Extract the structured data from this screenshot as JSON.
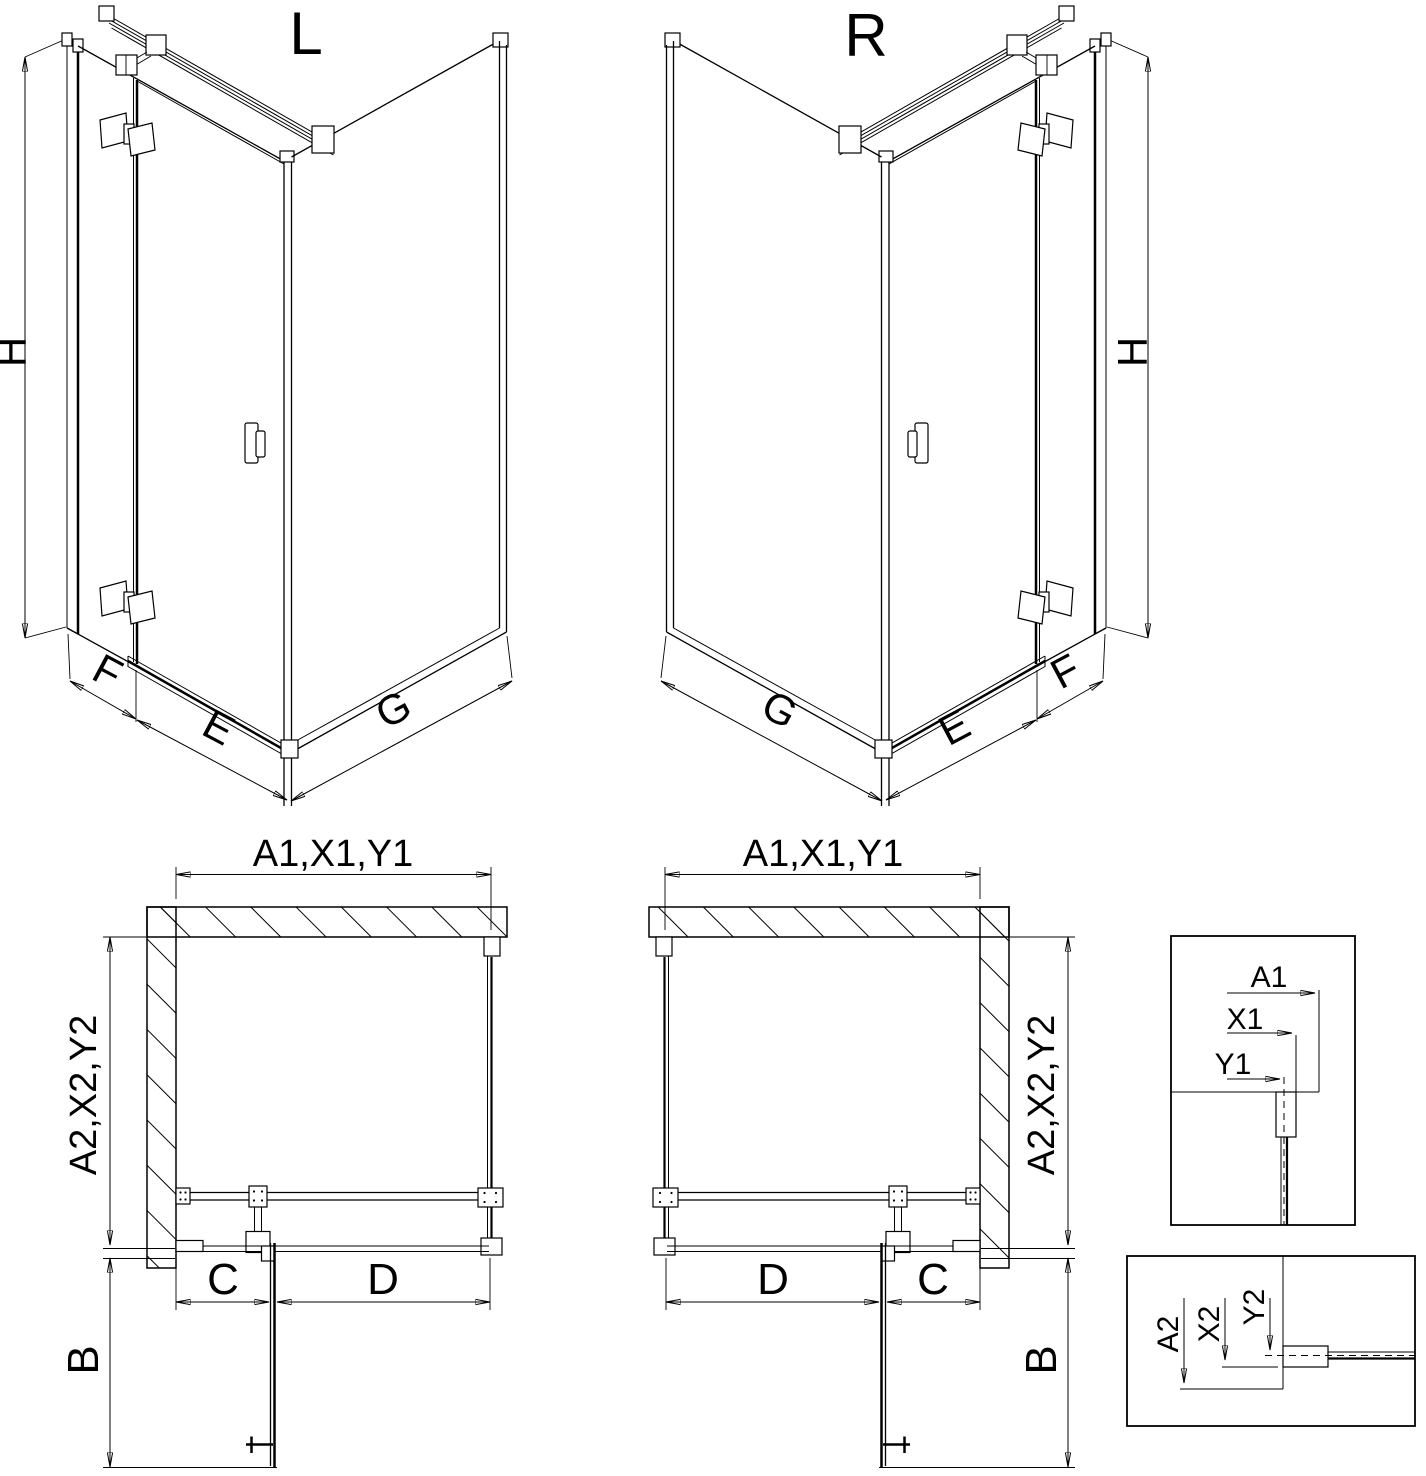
{
  "document": {
    "kind": "shower-enclosure-technical-drawing",
    "views": {
      "iso_left": {
        "title": "L",
        "height": "H",
        "side_panel": "F",
        "door": "E",
        "return_panel": "G"
      },
      "iso_right": {
        "title": "R",
        "height": "H",
        "side_panel": "F",
        "door": "E",
        "return_panel": "G"
      },
      "plan_left": {
        "width": "A1,X1,Y1",
        "depth": "A2,X2,Y2",
        "fixed_segment": "C",
        "door_segment": "D",
        "door_swing": "B"
      },
      "plan_right": {
        "width": "A1,X1,Y1",
        "depth": "A2,X2,Y2",
        "fixed_segment": "C",
        "door_segment": "D",
        "door_swing": "B"
      },
      "detail_width": {
        "a1": "A1",
        "x1": "X1",
        "y1": "Y1"
      },
      "detail_depth": {
        "a2": "A2",
        "x2": "X2",
        "y2": "Y2"
      }
    }
  }
}
